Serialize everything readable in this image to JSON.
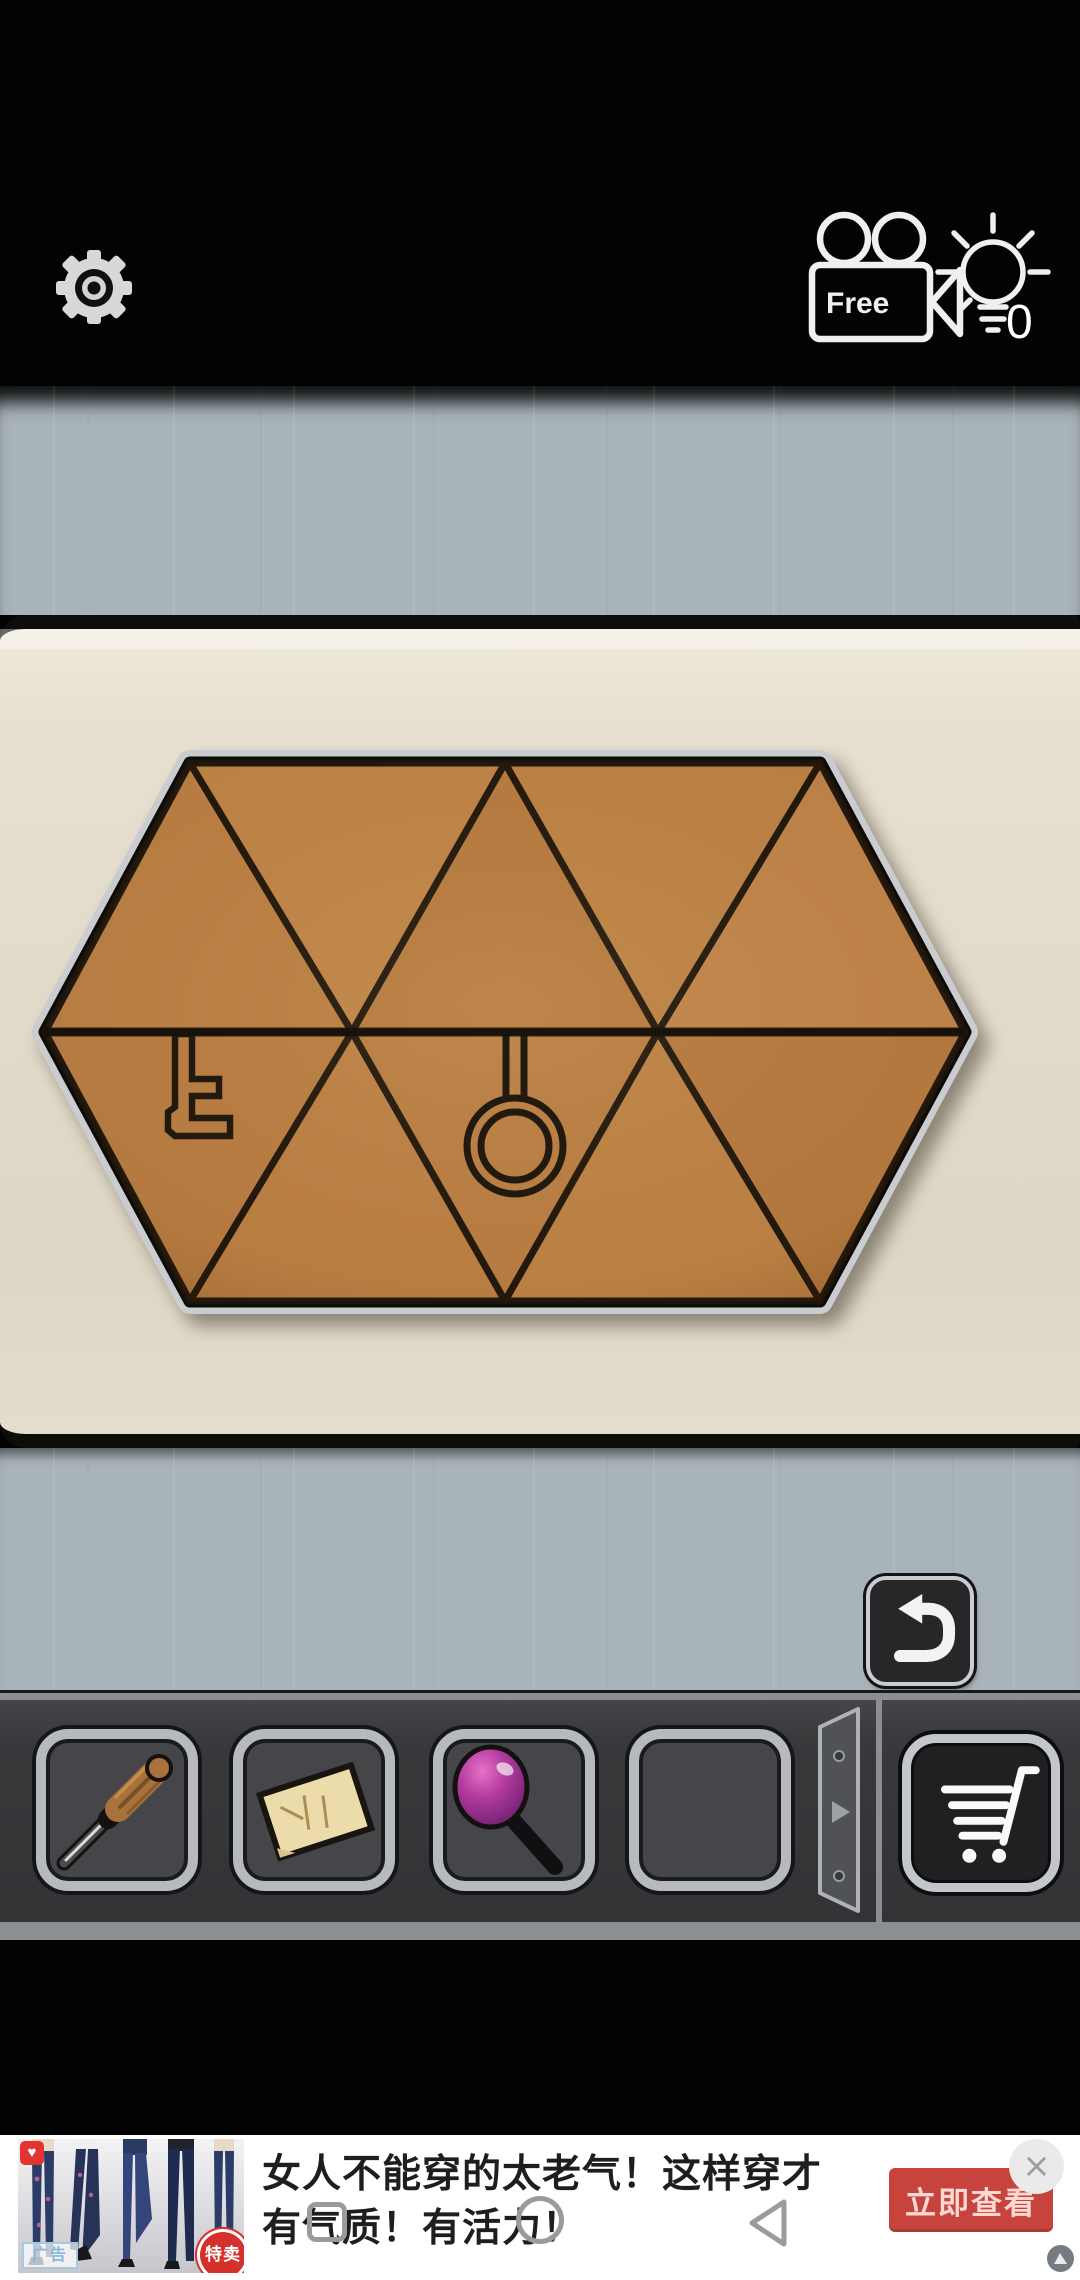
{
  "theme": {
    "wall": "#a9b4ba",
    "panel": "#e7e0d1",
    "bar": "#39393c",
    "tile": "#ba7f43",
    "tile_line": "#1d150c",
    "rim": "#c9cdcf",
    "accent_red": "#c7433e"
  },
  "topbar": {
    "settings_button": {
      "icon": "gear-icon"
    },
    "camera_button": {
      "icon": "video-camera-icon",
      "label": "Free"
    },
    "hint_button": {
      "icon": "lightbulb-icon",
      "count": "0"
    }
  },
  "puzzle": {
    "board_shape": "hexagon",
    "rows": 2,
    "triangles_per_row": 5,
    "engravings": [
      {
        "name": "key",
        "position": "bottom-left-triangle"
      },
      {
        "name": "ring-pendant",
        "position": "bottom-middle-triangle"
      }
    ]
  },
  "controls": {
    "undo_button": {
      "icon": "undo-arrow-icon"
    }
  },
  "inventory": {
    "slots": [
      {
        "item": "screwdriver"
      },
      {
        "item": "paper-note"
      },
      {
        "item": "magnifier"
      },
      {
        "item": "empty"
      }
    ],
    "page_arrow": {
      "icon": "page-next-icon"
    },
    "cart_button": {
      "icon": "shopping-cart-icon"
    }
  },
  "ad_banner": {
    "headline_line1": "女人不能穿的太老气！这样穿才",
    "headline_line2": "有气质！有活力！",
    "cta_label": "立即查看",
    "ad_tag": "广告",
    "sale_badge": "特卖",
    "close_label": "×",
    "heart_badge": "♥"
  },
  "nav": {
    "buttons": [
      "recents",
      "home",
      "back"
    ]
  }
}
